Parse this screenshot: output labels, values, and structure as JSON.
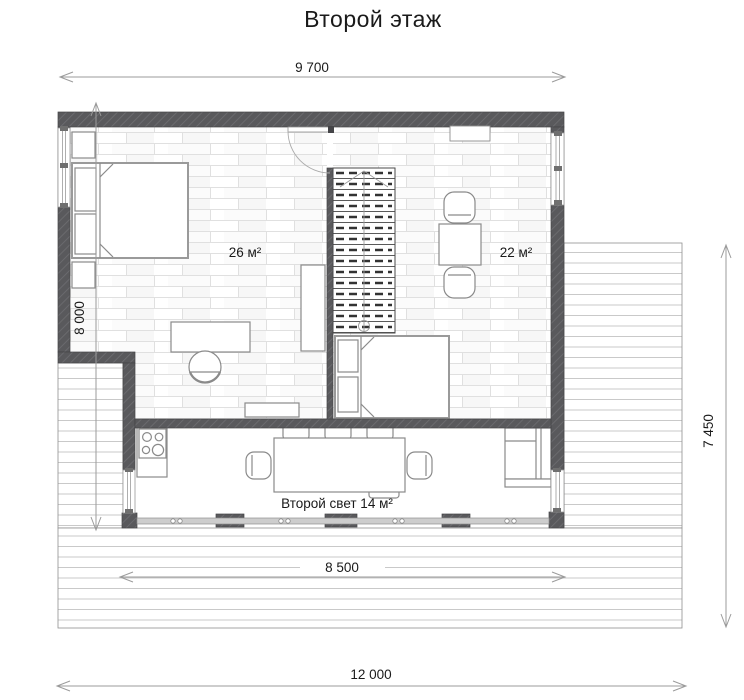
{
  "title": "Второй этаж",
  "dimensions": {
    "top_width": "9 700",
    "left_height": "8 000",
    "right_height": "7 450",
    "terrace_width": "8 500",
    "overall_width": "12 000"
  },
  "rooms": {
    "bedroom_area": "26 м²",
    "study_area": "22 м²",
    "second_light_area": "Второй свет 14 м²"
  },
  "colors": {
    "wall": "#59595c",
    "wall_hatch": "#6e6e72",
    "dimension": "#9b9b9b",
    "text": "#1a1a1a",
    "plank_line": "#e0e0e0",
    "deck_line": "#c9c9c9",
    "furniture": "#8a8a8a"
  }
}
